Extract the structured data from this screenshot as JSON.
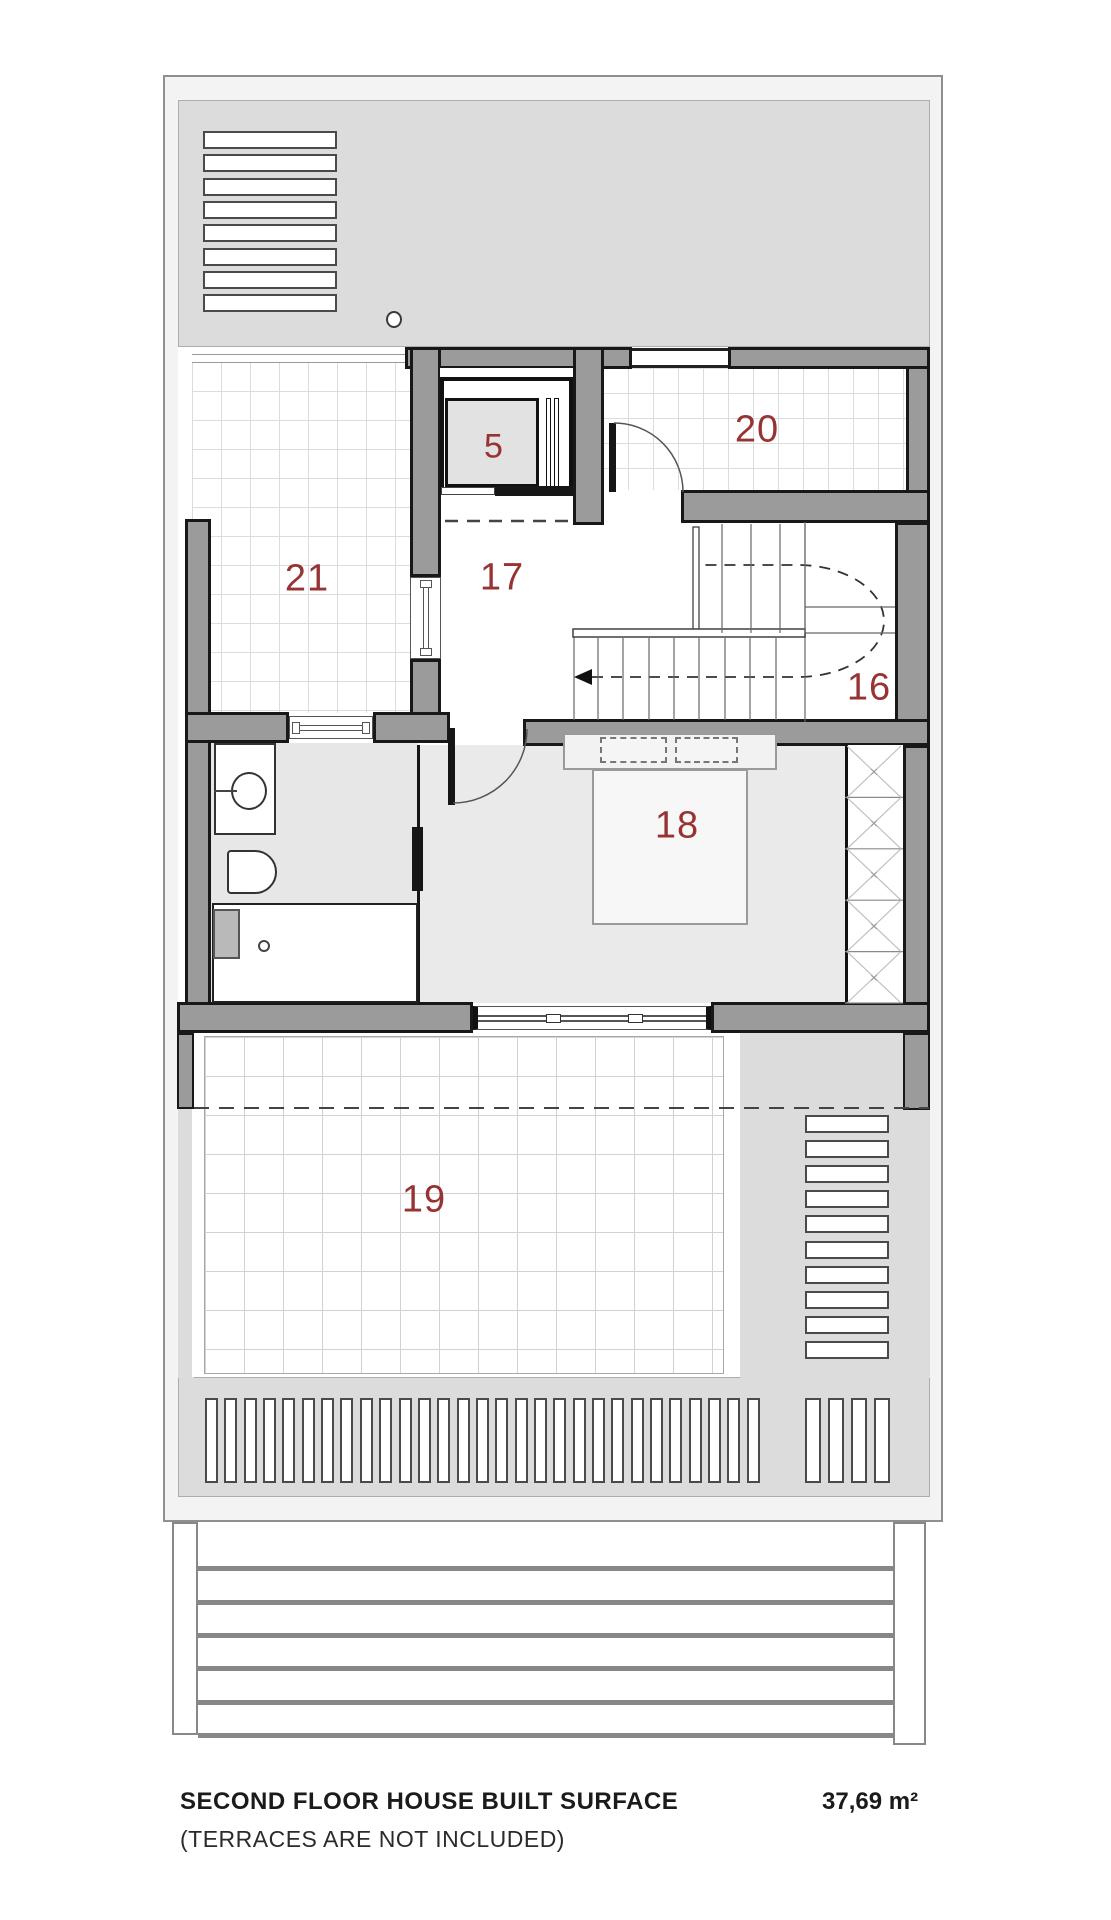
{
  "plan_title": "Second floor plan",
  "rooms": {
    "r5": "5",
    "r16": "16",
    "r17": "17",
    "r18": "18",
    "r19": "19",
    "r20": "20",
    "r21": "21"
  },
  "footer": {
    "title": "SECOND FLOOR HOUSE BUILT SURFACE",
    "subtitle": "(TERRACES ARE NOT INCLUDED)",
    "area_value": "37,69 m²"
  },
  "colors": {
    "wall": "#9b9b9b",
    "band": "#dcdcdc",
    "room_label": "#983333",
    "line_black": "#161616",
    "floor_light": "#eaeaea"
  },
  "louvers": {
    "top_left_count": 8,
    "right_stack_count": 10,
    "bottom_left_count": 29,
    "bottom_right_count": 4
  },
  "deck_plank_count": 6,
  "wardrobe_cell_count": 5,
  "stair": {
    "upper_tread_xs": [
      722,
      751,
      780,
      805
    ],
    "lower_tread_xs": [
      598,
      623,
      649,
      674,
      699,
      725,
      750,
      776
    ]
  }
}
